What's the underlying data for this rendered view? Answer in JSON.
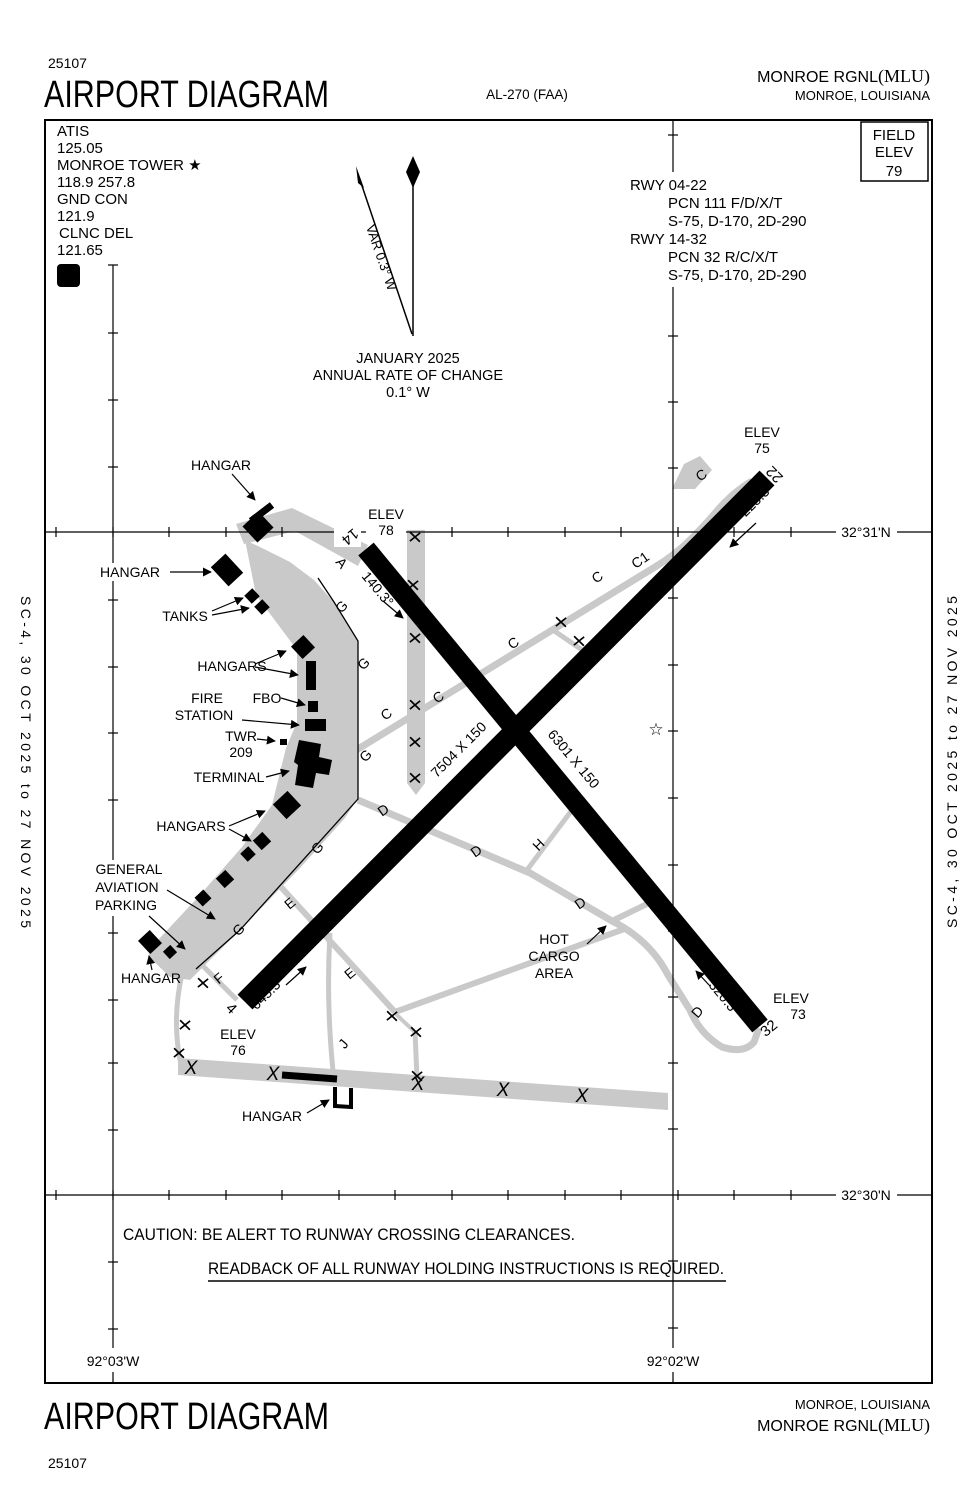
{
  "header": {
    "chart_number": "25107",
    "title": "AIRPORT DIAGRAM",
    "procedure_id": "AL-270 (FAA)",
    "airport_name": "MONROE RGNL",
    "airport_icao": "(MLU)",
    "city": "MONROE, LOUISIANA"
  },
  "footer": {
    "chart_number": "25107",
    "title": "AIRPORT DIAGRAM",
    "airport_name": "MONROE RGNL",
    "airport_icao": "(MLU)",
    "city": "MONROE, LOUISIANA"
  },
  "comm_box": {
    "atis_label": "ATIS",
    "atis_freq": "125.05",
    "tower_label": "MONROE TOWER ★",
    "tower_freq": "118.9  257.8",
    "gnd_label": "GND CON",
    "gnd_freq": "121.9",
    "clnc_label": "CLNC DEL",
    "clnc_freq": "121.65",
    "d_symbol": "D"
  },
  "field_elev_box": {
    "line1": "FIELD",
    "line2": "ELEV",
    "value": "79"
  },
  "runway_info": {
    "rows": [
      {
        "rwy": "RWY  04-22",
        "pcn": "PCN 111 F/D/X/T",
        "strength": "S-75, D-170, 2D-290"
      },
      {
        "rwy": "RWY  14-32",
        "pcn": "PCN 32 R/C/X/T",
        "strength": "S-75, D-170, 2D-290"
      }
    ]
  },
  "compass": {
    "variation": "VAR 0.3° W",
    "date": "JANUARY 2025",
    "rate_label": "ANNUAL RATE OF CHANGE",
    "rate_value": "0.1° W"
  },
  "caution": {
    "line1": "CAUTION: BE ALERT TO RUNWAY CROSSING CLEARANCES.",
    "line2": "READBACK OF ALL RUNWAY HOLDING INSTRUCTIONS IS REQUIRED."
  },
  "edge_note": "SC-4,  30 OCT 2025  to  27 NOV 2025",
  "map": {
    "labels": [
      {
        "id": "hangar-label-1",
        "t": "HANGAR",
        "x": 221,
        "y": 470
      },
      {
        "id": "hangar-label-2",
        "t": "HANGAR",
        "x": 130,
        "y": 577
      },
      {
        "id": "tanks-label",
        "t": "TANKS",
        "x": 185,
        "y": 621
      },
      {
        "id": "hangars-label-1",
        "t": "HANGARS",
        "x": 232,
        "y": 671
      },
      {
        "id": "fire-station-label-1",
        "t": "FIRE",
        "x": 207,
        "y": 703
      },
      {
        "id": "fire-station-label-2",
        "t": "STATION",
        "x": 204,
        "y": 720
      },
      {
        "id": "fbo-label",
        "t": "FBO",
        "x": 267,
        "y": 703
      },
      {
        "id": "twr-label",
        "t": "TWR",
        "x": 241,
        "y": 741
      },
      {
        "id": "twr-elev-label",
        "t": "209",
        "x": 241,
        "y": 757
      },
      {
        "id": "terminal-label",
        "t": "TERMINAL",
        "x": 229,
        "y": 782
      },
      {
        "id": "hangars-label-2",
        "t": "HANGARS",
        "x": 191,
        "y": 831
      },
      {
        "id": "ga-parking-label-1",
        "t": "GENERAL",
        "x": 129,
        "y": 874
      },
      {
        "id": "ga-parking-label-2",
        "t": "AVIATION",
        "x": 127,
        "y": 892
      },
      {
        "id": "ga-parking-label-3",
        "t": "PARKING",
        "x": 126,
        "y": 910
      },
      {
        "id": "hangar-label-3",
        "t": "HANGAR",
        "x": 151,
        "y": 983
      },
      {
        "id": "hangar-label-4",
        "t": "HANGAR",
        "x": 272,
        "y": 1121
      },
      {
        "id": "hot-cargo-label-1",
        "t": "HOT",
        "x": 554,
        "y": 944
      },
      {
        "id": "hot-cargo-label-2",
        "t": "CARGO",
        "x": 554,
        "y": 961
      },
      {
        "id": "hot-cargo-label-3",
        "t": "AREA",
        "x": 554,
        "y": 978
      },
      {
        "id": "elev-78-label",
        "t": "ELEV",
        "x": 386,
        "y": 519
      },
      {
        "id": "elev-78-value",
        "t": "78",
        "x": 386,
        "y": 535
      },
      {
        "id": "elev-75-label",
        "t": "ELEV",
        "x": 762,
        "y": 437
      },
      {
        "id": "elev-75-value",
        "t": "75",
        "x": 762,
        "y": 453
      },
      {
        "id": "elev-73-label",
        "t": "ELEV",
        "x": 791,
        "y": 1003
      },
      {
        "id": "elev-73-value",
        "t": "73",
        "x": 798,
        "y": 1019
      },
      {
        "id": "elev-76-label",
        "t": "ELEV",
        "x": 238,
        "y": 1039
      },
      {
        "id": "elev-76-value",
        "t": "76",
        "x": 238,
        "y": 1055
      },
      {
        "id": "rwy-num-14",
        "t": "14",
        "x": 347,
        "y": 533,
        "r": 140,
        "fs": 15
      },
      {
        "id": "rwy-num-22",
        "t": "22",
        "x": 778,
        "y": 471,
        "r": 225,
        "fs": 15
      },
      {
        "id": "rwy-num-4",
        "t": "4",
        "x": 228,
        "y": 1012,
        "r": 45,
        "fs": 15
      },
      {
        "id": "rwy-num-32",
        "t": "32",
        "x": 772,
        "y": 1032,
        "r": -40,
        "fs": 15
      },
      {
        "id": "hdg-140",
        "t": "140.3°",
        "x": 374,
        "y": 592,
        "r": 50
      },
      {
        "id": "hdg-225",
        "t": "225.3°",
        "x": 760,
        "y": 503,
        "r": -45
      },
      {
        "id": "hdg-045",
        "t": "045.3°",
        "x": 271,
        "y": 996,
        "r": -45
      },
      {
        "id": "hdg-320",
        "t": "320.3°",
        "x": 721,
        "y": 1001,
        "r": 50
      },
      {
        "id": "rwy-dim-0422",
        "t": "7504 X 150",
        "x": 462,
        "y": 753,
        "r": -45
      },
      {
        "id": "rwy-dim-1432",
        "t": "6301 X 150",
        "x": 570,
        "y": 762,
        "r": 50
      },
      {
        "id": "twy-a-label",
        "t": "A",
        "x": 338,
        "y": 566,
        "r": 50
      },
      {
        "id": "twy-c-label-1",
        "t": "C",
        "x": 389,
        "y": 718,
        "r": -35
      },
      {
        "id": "twy-c-label-2",
        "t": "C",
        "x": 441,
        "y": 701,
        "r": -35
      },
      {
        "id": "twy-c-label-3",
        "t": "C",
        "x": 516,
        "y": 647,
        "r": -35
      },
      {
        "id": "twy-c-label-4",
        "t": "C",
        "x": 600,
        "y": 581,
        "r": -35
      },
      {
        "id": "twy-c-label-5",
        "t": "C",
        "x": 704,
        "y": 479,
        "r": -35
      },
      {
        "id": "twy-c1-label",
        "t": "C1",
        "x": 643,
        "y": 564,
        "r": -35
      },
      {
        "id": "twy-g-label-1",
        "t": "G",
        "x": 345,
        "y": 610,
        "r": -45
      },
      {
        "id": "twy-g-label-2",
        "t": "G",
        "x": 367,
        "y": 667,
        "r": -45
      },
      {
        "id": "twy-g-label-3",
        "t": "G",
        "x": 369,
        "y": 759,
        "r": -45
      },
      {
        "id": "twy-g-label-4",
        "t": "G",
        "x": 321,
        "y": 851,
        "r": -50
      },
      {
        "id": "twy-g-label-5",
        "t": "G",
        "x": 242,
        "y": 933,
        "r": -45
      },
      {
        "id": "twy-d-label-1",
        "t": "D",
        "x": 386,
        "y": 814,
        "r": -35
      },
      {
        "id": "twy-d-label-2",
        "t": "D",
        "x": 479,
        "y": 855,
        "r": -35
      },
      {
        "id": "twy-d-label-3",
        "t": "D",
        "x": 583,
        "y": 907,
        "r": -35
      },
      {
        "id": "twy-d-label-4",
        "t": "D",
        "x": 701,
        "y": 1015,
        "r": -50
      },
      {
        "id": "twy-e-label-1",
        "t": "E",
        "x": 293,
        "y": 907,
        "r": -40
      },
      {
        "id": "twy-e-label-2",
        "t": "E",
        "x": 353,
        "y": 977,
        "r": -40
      },
      {
        "id": "twy-f-label",
        "t": "F",
        "x": 222,
        "y": 982,
        "r": -40
      },
      {
        "id": "twy-h-label",
        "t": "H",
        "x": 542,
        "y": 848,
        "r": -45
      },
      {
        "id": "twy-j-label",
        "t": "J",
        "x": 347,
        "y": 1047,
        "r": -50
      },
      {
        "id": "beacon-star-icon",
        "t": "☆",
        "x": 656,
        "y": 735,
        "fs": 17
      },
      {
        "id": "lat-label-top",
        "t": "32°31'N",
        "x": 866,
        "y": 537
      },
      {
        "id": "lat-label-bottom",
        "t": "32°30'N",
        "x": 866,
        "y": 1200
      },
      {
        "id": "lon-label-left",
        "t": "92°03'W",
        "x": 113,
        "y": 1366
      },
      {
        "id": "lon-label-right",
        "t": "92°02'W",
        "x": 673,
        "y": 1366
      }
    ],
    "closed_x_small": [
      [
        415,
        537
      ],
      [
        413,
        585
      ],
      [
        415,
        638
      ],
      [
        415,
        705
      ],
      [
        415,
        742
      ],
      [
        415,
        778
      ],
      [
        561,
        622
      ],
      [
        579,
        641
      ],
      [
        203,
        983
      ],
      [
        185,
        1025
      ],
      [
        179,
        1053
      ],
      [
        392,
        1016
      ],
      [
        416,
        1032
      ],
      [
        417,
        1076
      ]
    ],
    "closed_runway_x": [
      [
        191,
        1067
      ],
      [
        273,
        1073
      ],
      [
        418,
        1083
      ],
      [
        503,
        1089
      ],
      [
        582,
        1095
      ]
    ]
  }
}
